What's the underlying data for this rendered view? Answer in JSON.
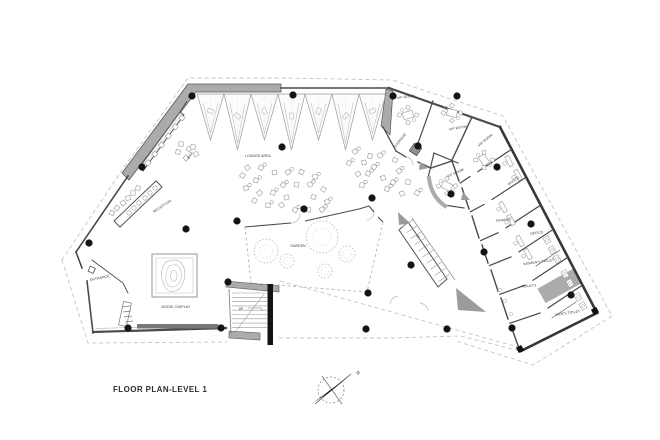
{
  "drawing": {
    "title": "FLOOR PLAN-LEVEL 1",
    "type_note": "architectural floor plan"
  },
  "compass": {
    "north": "N"
  },
  "labels": {
    "bar": "BAR",
    "lounge_area": "LOUNGE AREA",
    "reception": "RECEPTION",
    "entrance": "ENTRANCE",
    "model_display": "MODEL DISPLAY",
    "garden": "GARDEN",
    "up": "UP",
    "vip_room": "VIP ROOM",
    "storage": "STORAGE",
    "office": "OFFICE",
    "finance": "FINANCE",
    "womens_toilet": "WOMEN'S TOILET",
    "toilets": "TOILETS",
    "mens_toilet": "MEN'S TOILET"
  },
  "colors": {
    "background": "#ffffff",
    "thick_wall_gray": "#ababab",
    "wall_line": "#4a4a4a",
    "column_black": "#141414",
    "site_dash": "#c4c4c4"
  }
}
